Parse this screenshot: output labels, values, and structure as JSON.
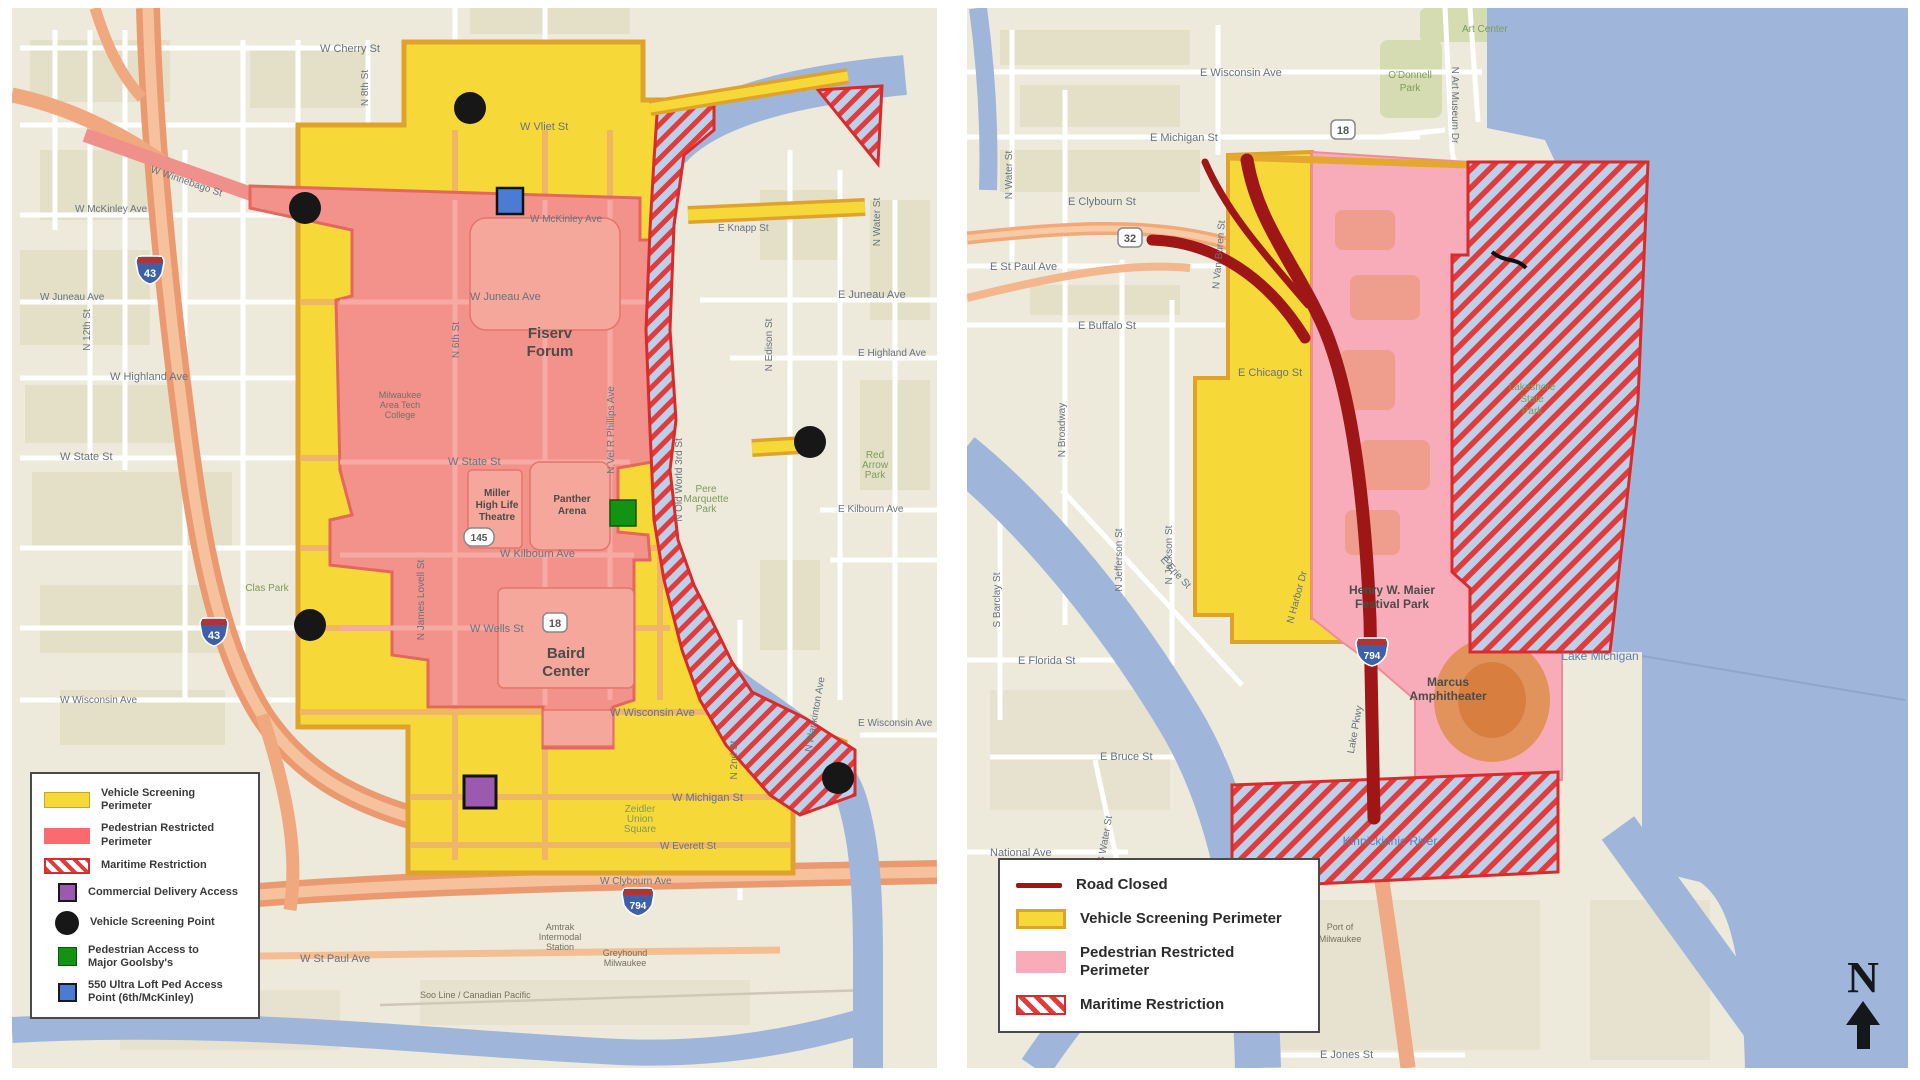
{
  "left_map": {
    "legend": {
      "items": [
        {
          "label": "Vehicle Screening Perimeter"
        },
        {
          "label": "Pedestrian Restricted Perimeter"
        },
        {
          "label": "Maritime Restriction"
        },
        {
          "label": "Commercial Delivery Access"
        },
        {
          "label": "Vehicle Screening Point"
        },
        {
          "label": "Pedestrian Access to Major Goolsby's"
        },
        {
          "label": "550 Ultra Loft Ped Access Point (6th/McKinley)"
        }
      ]
    },
    "streets": {
      "w_cherry": "W Cherry St",
      "w_vliet": "W Vliet St",
      "w_mckinley": "W McKinley Ave",
      "w_winnebago": "W Winnebago St",
      "w_juneau": "W Juneau Ave",
      "e_juneau": "E Juneau Ave",
      "w_highland": "W Highland Ave",
      "e_highland": "E Highland Ave",
      "w_state": "W State St",
      "w_kilbourn": "W Kilbourn Ave",
      "e_kilbourn": "E Kilbourn Ave",
      "w_wells": "W Wells St",
      "w_wisconsin": "W Wisconsin Ave",
      "e_wisconsin": "E Wisconsin Ave",
      "w_michigan": "W Michigan St",
      "w_everett": "W Everett St",
      "w_clybourn": "W Clybourn Ave",
      "w_stpaul": "W St Paul Ave",
      "e_knapp": "E Knapp St",
      "n_12th": "N 12th St",
      "n_8th": "N 8th St",
      "n_6th": "N 6th St",
      "n_vel": "N Vel R Phillips Ave",
      "n_james": "N James Lovell St",
      "n_old3": "N Old World 3rd St",
      "n_water": "N Water St",
      "n_edison": "N Edison St",
      "n_2nd": "N 2nd St",
      "n_plankinton": "N Plankinton Ave"
    },
    "places": {
      "fiserv_1": "Fiserv",
      "fiserv_2": "Forum",
      "miller_1": "Miller",
      "miller_2": "High Life",
      "miller_3": "Theatre",
      "panther_1": "Panther",
      "panther_2": "Arena",
      "baird_1": "Baird",
      "baird_2": "Center",
      "pere_1": "Pere",
      "pere_2": "Marquette",
      "pere_3": "Park",
      "clas": "Clas Park",
      "redarrow_1": "Red",
      "redarrow_2": "Arrow",
      "redarrow_3": "Park",
      "zeidler_1": "Zeidler",
      "zeidler_2": "Union",
      "zeidler_3": "Square",
      "matc_1": "Milwaukee",
      "matc_2": "Area Tech",
      "matc_3": "College",
      "amtrak_1": "Amtrak",
      "amtrak_2": "Intermodal",
      "amtrak_3": "Station",
      "grey_1": "Greyhound",
      "grey_2": "Milwaukee",
      "soo": "Soo Line / Canadian Pacific"
    },
    "shields": {
      "i43": "43",
      "i794": "794",
      "us18": "18",
      "s145": "145"
    }
  },
  "right_map": {
    "legend": {
      "items": [
        {
          "label": "Road Closed"
        },
        {
          "label": "Vehicle Screening Perimeter"
        },
        {
          "label": "Pedestrian Restricted Perimeter"
        },
        {
          "label": "Maritime Restriction"
        }
      ]
    },
    "streets": {
      "e_wisconsin": "E Wisconsin Ave",
      "e_michigan": "E Michigan St",
      "e_clybourn": "E Clybourn St",
      "e_stpaul": "E St Paul Ave",
      "e_buffalo": "E Buffalo St",
      "e_chicago": "E Chicago St",
      "e_erie": "E Erie St",
      "e_florida": "E Florida St",
      "e_bruce": "E Bruce St",
      "national": "National Ave",
      "e_jones": "E Jones St",
      "n_water": "N Water St",
      "n_broadway": "N Broadway",
      "n_jefferson": "N Jefferson St",
      "n_jackson": "N Jackson St",
      "n_vanburen": "N Van Buren St",
      "n_harbor": "N Harbor Dr",
      "lake_pkwy": "Lake Pkwy",
      "n_artmuseum": "N Art Museum Dr",
      "s_barclay": "S Barclay St",
      "s_water": "S Water St"
    },
    "places": {
      "art_center": "Art Center",
      "od_1": "O'Donnell",
      "od_2": "Park",
      "henry_1": "Henry W. Maier",
      "henry_2": "Festival Park",
      "marcus_1": "Marcus",
      "marcus_2": "Amphitheater",
      "ls_1": "Lakeshore",
      "ls_2": "State",
      "ls_3": "Park",
      "port_1": "Port of",
      "port_2": "Milwaukee",
      "lake_michigan": "Lake Michigan",
      "kk_river": "Kinnickinnic River"
    },
    "shields": {
      "us18": "18",
      "s32": "32",
      "i794": "794"
    }
  },
  "compass": {
    "north": "N"
  },
  "colors": {
    "vehicle_screening": "#F6D838",
    "vehicle_border": "#DFA32B",
    "pedestrian_restricted_left": "#F2928B",
    "pedestrian_restricted_right": "#F8ABB8",
    "maritime_stripe": "#E23B3B",
    "road_closed": "#9E1616",
    "water": "#9FB6DA"
  }
}
